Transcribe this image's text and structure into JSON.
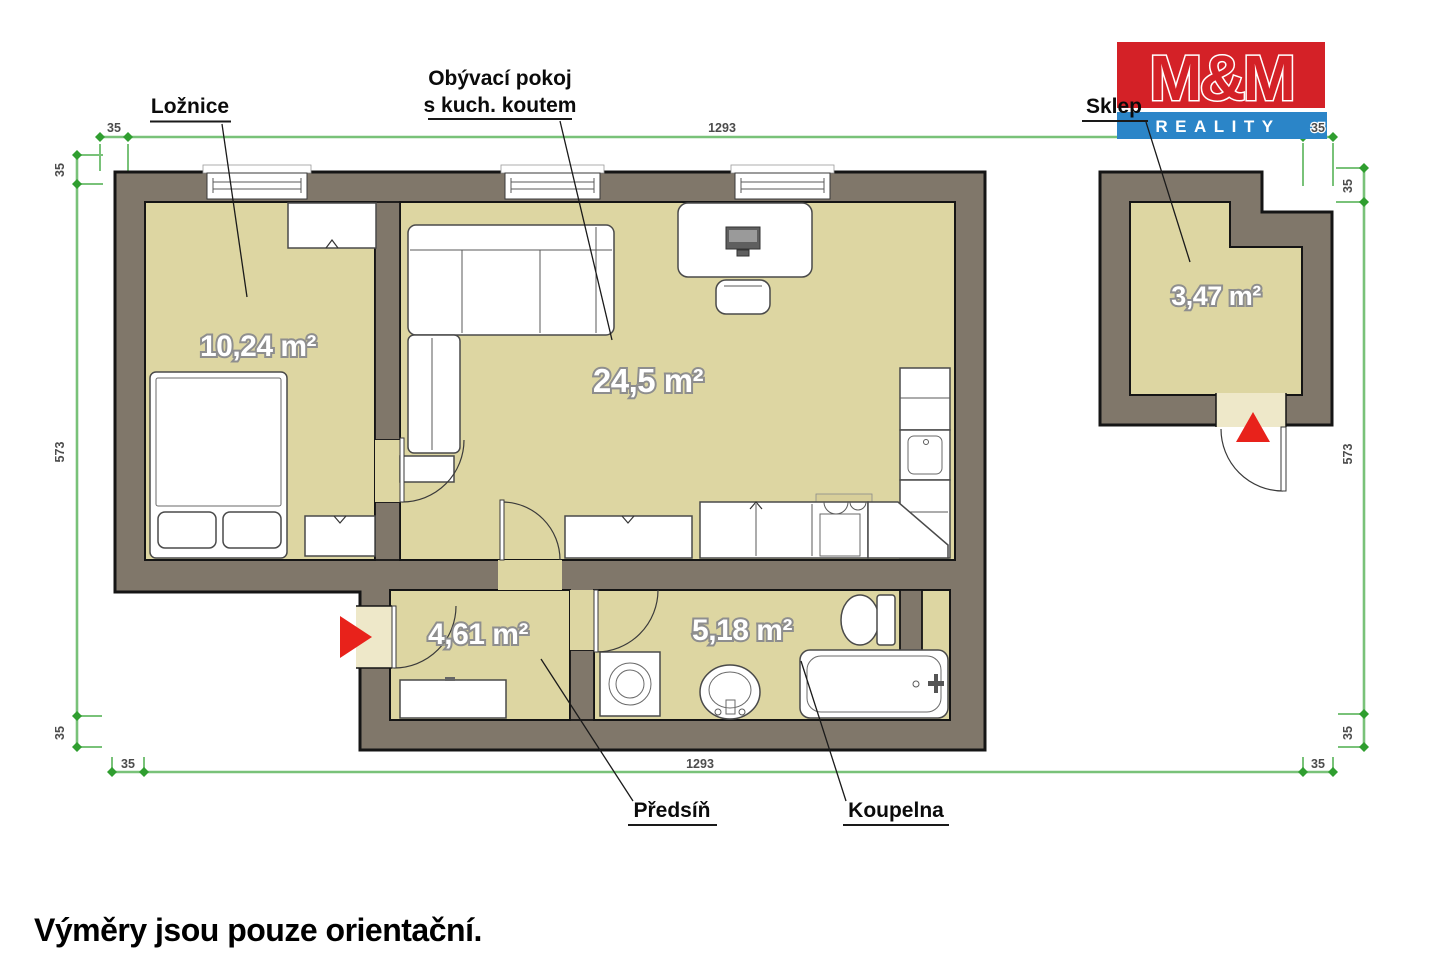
{
  "disclaimer": "Výměry jsou pouze orientační.",
  "logo": {
    "title": "M&M",
    "subtitle": "REALITY"
  },
  "rooms": [
    {
      "name": "Ložnice",
      "area": "10,24 m²"
    },
    {
      "name": "Obývací pokoj",
      "name_line2": "s kuch. koutem",
      "area": "24,5 m²"
    },
    {
      "name": "Předsíň",
      "area": "4,61 m²"
    },
    {
      "name": "Koupelna",
      "area": "5,18 m²"
    },
    {
      "name": "Sklep",
      "area": "3,47 m²"
    }
  ],
  "dimensions": {
    "top": {
      "left": "35",
      "center": "1293",
      "right": "35"
    },
    "bottom": {
      "left": "35",
      "center": "1293",
      "right": "35"
    },
    "left": {
      "top": "35",
      "middle": "573",
      "bottom": "35"
    },
    "right": {
      "top": "35",
      "middle": "573",
      "bottom": "35"
    }
  },
  "colors": {
    "wall": "#80776a",
    "floor": "#ddd6a2",
    "floor_light": "#eee8c9",
    "dim_green": "#79c279",
    "dim_tick": "#2f9e2f",
    "marker_red": "#e8221b",
    "logo_red": "#d42127",
    "logo_blue": "#2b85c8"
  }
}
